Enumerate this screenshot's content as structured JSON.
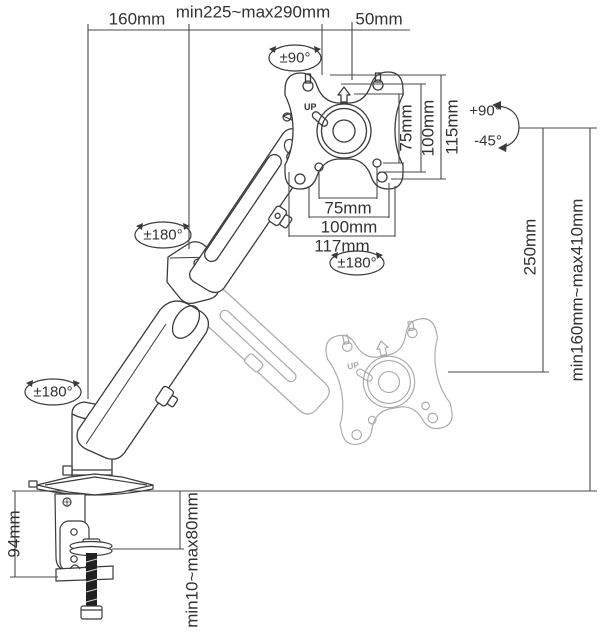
{
  "diagram": {
    "type": "technical-dimension-drawing",
    "subject": "gas-spring monitor desk mount arm",
    "dimensions": {
      "arm_offset": "160mm",
      "arm_reach": "min225~max290mm",
      "head_offset": "50mm",
      "vesa_vertical_75": "75mm",
      "vesa_vertical_100": "100mm",
      "plate_height_115": "115mm",
      "vesa_horizontal_75": "75mm",
      "vesa_horizontal_100": "100mm",
      "plate_width_117": "117mm",
      "upper_arm_drop_250": "250mm",
      "height_range": "min160mm~max410mm",
      "clamp_height_94": "94mm",
      "desk_thickness_range": "min10~max80mm"
    },
    "rotations": {
      "head_swivel": "±90°",
      "plate_rotation": "±180°",
      "elbow_rotation": "±180°",
      "base_rotation": "±180°",
      "tilt_up": "+90°",
      "tilt_down": "-45°"
    },
    "plate_markings": {
      "up_main": "UP",
      "up_ghost": "UP"
    },
    "colors": {
      "line": "#3b3b3b",
      "ghost": "#a9a9a9",
      "dimension_line": "#4a4a4a",
      "text": "#323232",
      "screw_rod": "#202020",
      "background": "#ffffff"
    }
  }
}
